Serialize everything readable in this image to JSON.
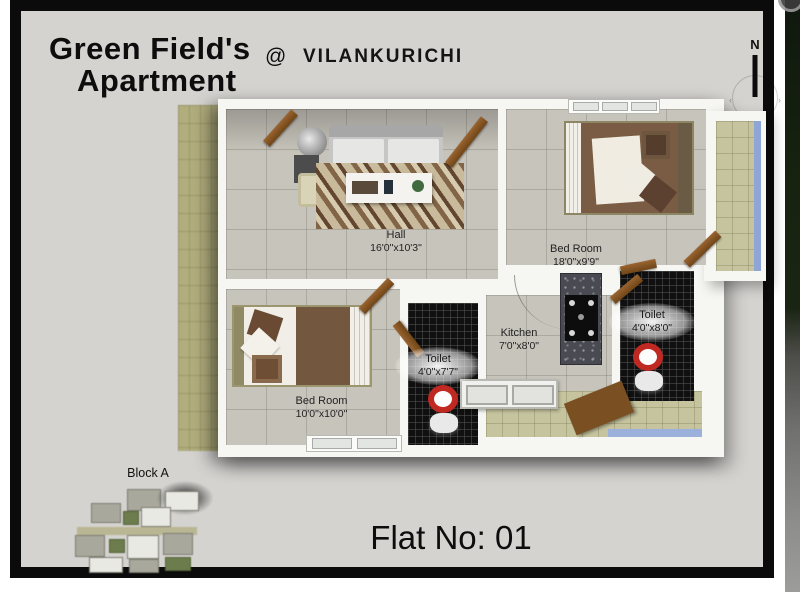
{
  "header": {
    "title_line1": "Green Field's",
    "title_line2": "Apartment",
    "at_symbol": "@",
    "location": "VILANKURICHI"
  },
  "compass": {
    "north_label": "N"
  },
  "plan": {
    "rooms": {
      "hall": {
        "label": "Hall",
        "size": "16'0\"x10'3\""
      },
      "bedroom1": {
        "label": "Bed Room",
        "size": "18'0\"x9'9\""
      },
      "bedroom2": {
        "label": "Bed Room",
        "size": "10'0\"x10'0\""
      },
      "kitchen": {
        "label": "Kitchen",
        "size": "7'0\"x8'0\""
      },
      "toilet1": {
        "label": "Toilet",
        "size": "4'0\"x7'7\""
      },
      "toilet2": {
        "label": "Toilet",
        "size": "4'0\"x8'0\""
      }
    }
  },
  "block": {
    "label": "Block A"
  },
  "footer": {
    "flat_no": "Flat No: 01"
  },
  "colors": {
    "frame": "#0b0b0b",
    "card_background": "#d4d3d0",
    "wall": "#f6f6f3",
    "floor_tile": "#c7c4bb",
    "toilet_tile": "#101010",
    "balcony_floor": "#c6c49e",
    "glass_blue": "#8fa5d6",
    "door_wood": "#8a5a28",
    "toilet_seat_red": "#c02822"
  }
}
